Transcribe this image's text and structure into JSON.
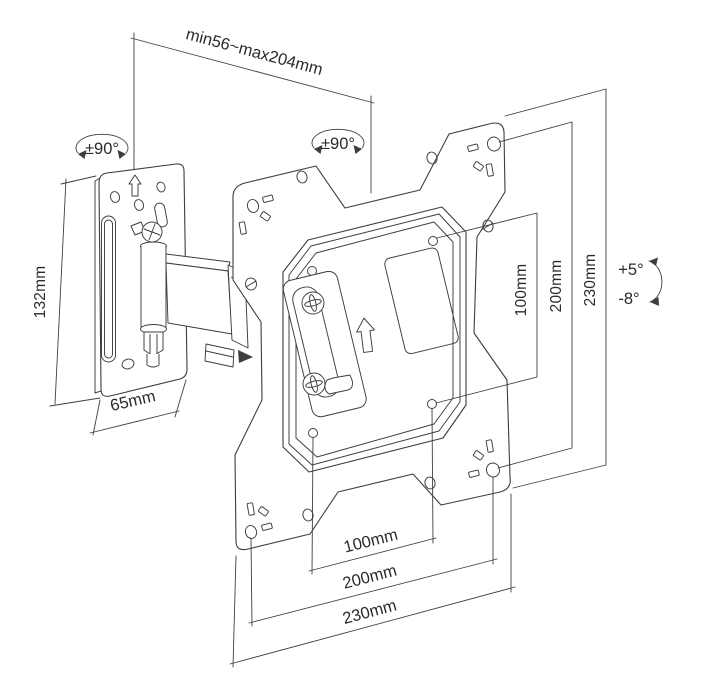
{
  "labels": {
    "extension_range": "min56~max204mm",
    "swivel_left": "±90°",
    "swivel_right": "±90°",
    "wall_plate_height": "132mm",
    "wall_plate_width": "65mm",
    "tilt_up": "+5°",
    "tilt_down": "-8°",
    "right_dims": {
      "d100": "100mm",
      "d200": "200mm",
      "d230": "230mm"
    },
    "bottom_dims": {
      "d100": "100mm",
      "d200": "200mm",
      "d230": "230mm"
    }
  },
  "colors": {
    "line": "#3d3d3d",
    "text": "#2b2b2b",
    "background": "#ffffff"
  }
}
